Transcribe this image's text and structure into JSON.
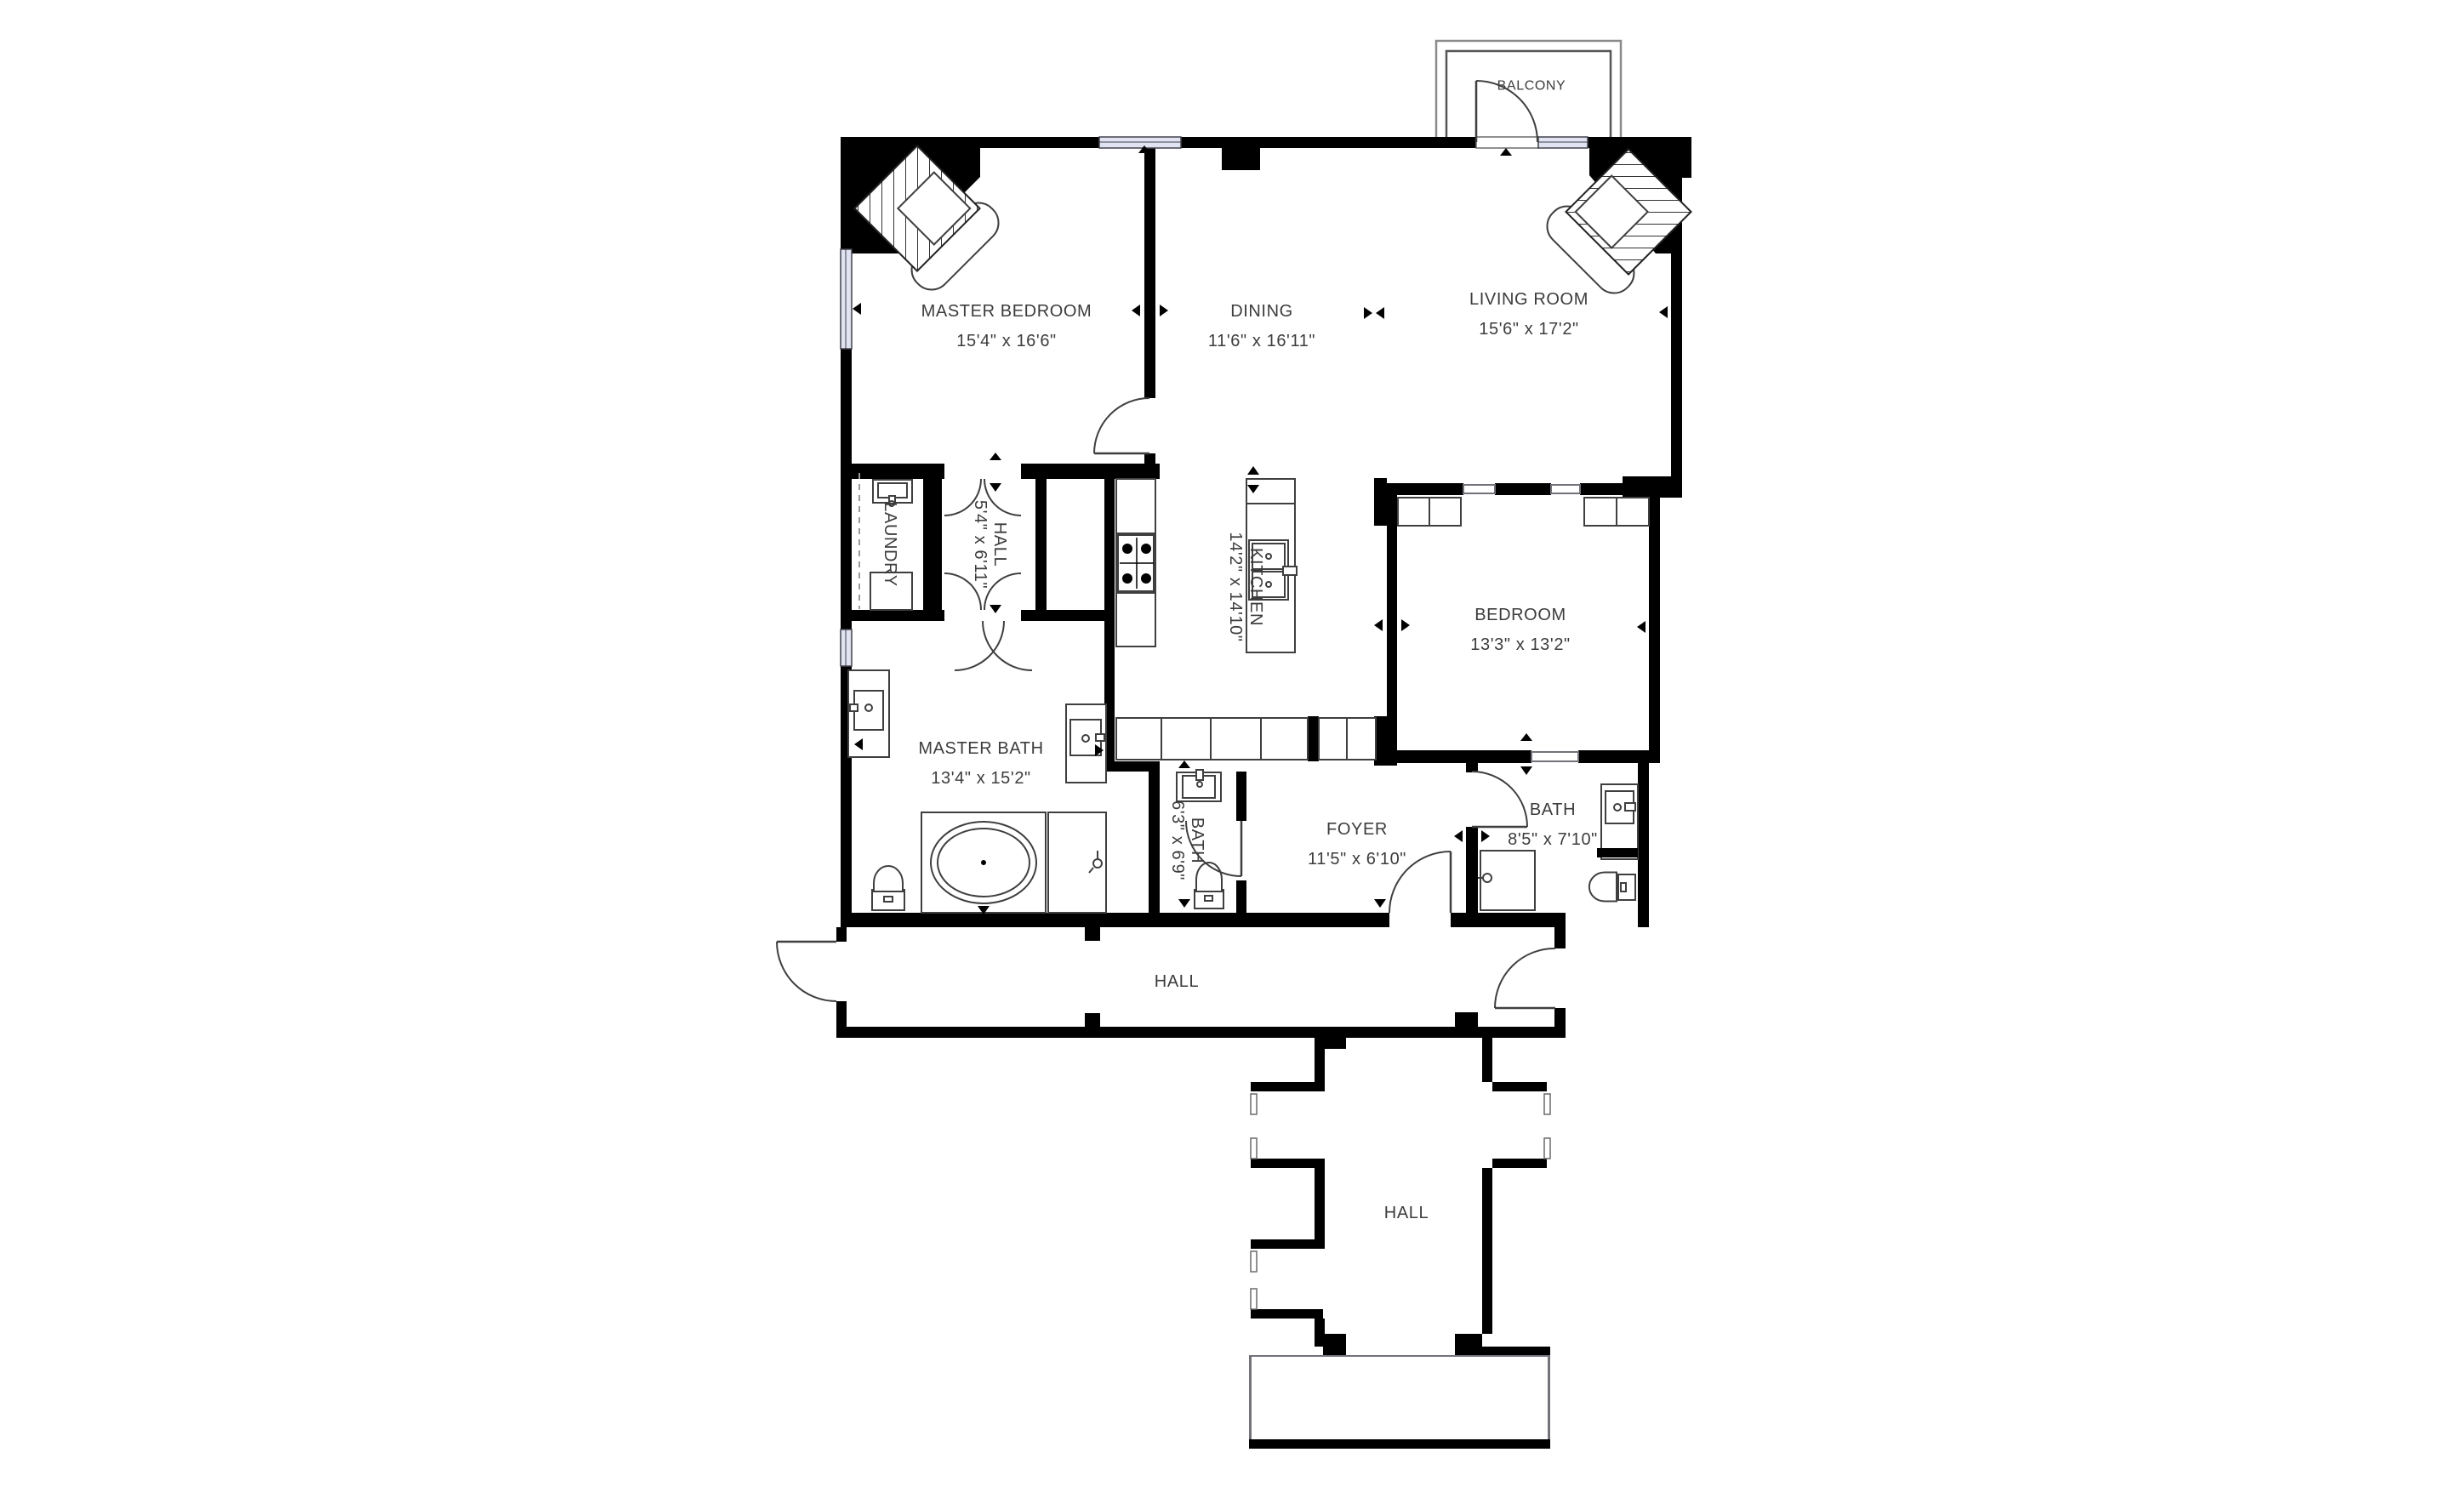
{
  "plan": {
    "title": "Apartment floor plan",
    "colors": {
      "wall": "#000000",
      "text": "#3c3c3c",
      "window_fill": "#dfe3f2",
      "line": "#3f3f3f"
    },
    "rooms": {
      "balcony": {
        "label": "BALCONY"
      },
      "master_bedroom": {
        "label": "MASTER BEDROOM",
        "dims": "15'4\" x 16'6\""
      },
      "dining": {
        "label": "DINING",
        "dims": "11'6\" x 16'11\""
      },
      "living_room": {
        "label": "LIVING ROOM",
        "dims": "15'6\" x 17'2\""
      },
      "laundry": {
        "label": "LAUNDRY"
      },
      "hall_small": {
        "label": "HALL",
        "dims": "5'4\" x 6'11\""
      },
      "kitchen": {
        "label": "KITCHEN",
        "dims": "14'2\" x 14'10\""
      },
      "bedroom": {
        "label": "BEDROOM",
        "dims": "13'3\" x 13'2\""
      },
      "master_bath": {
        "label": "MASTER BATH",
        "dims": "13'4\" x 15'2\""
      },
      "bath_small": {
        "label": "BATH",
        "dims": "6'3\" x 6'9\""
      },
      "foyer": {
        "label": "FOYER",
        "dims": "11'5\" x 6'10\""
      },
      "bath": {
        "label": "BATH",
        "dims": "8'5\" x 7'10\""
      },
      "hall_mid": {
        "label": "HALL"
      },
      "hall_lower": {
        "label": "HALL"
      }
    }
  }
}
